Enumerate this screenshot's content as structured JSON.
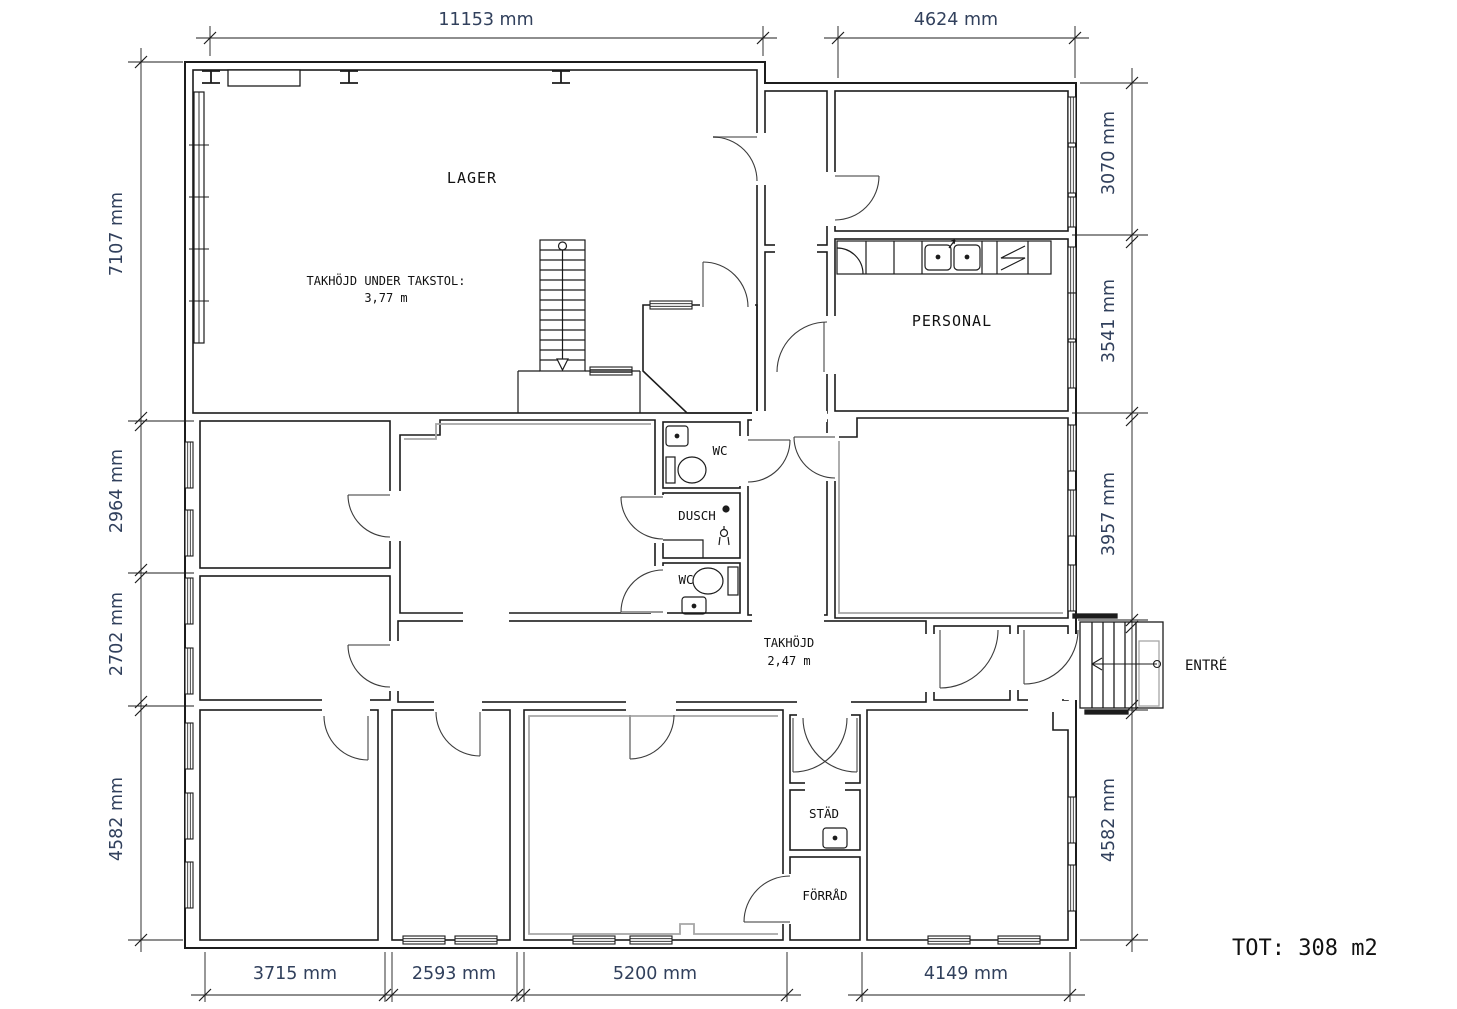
{
  "colors": {
    "wall": "#1c1c1c",
    "accent_gray": "#a6a6a6",
    "door_leaf_gray": "#9a9a9a",
    "dimension_text": "#31405c",
    "background": "#ffffff"
  },
  "dims": {
    "top": [
      "11153 mm",
      "4624 mm"
    ],
    "left": [
      "7107 mm",
      "2964 mm",
      "2702 mm",
      "4582 mm"
    ],
    "right": [
      "3070 mm",
      "3541 mm",
      "3957 mm",
      "4582 mm"
    ],
    "bottom": [
      "3715 mm",
      "2593 mm",
      "5200 mm",
      "4149 mm"
    ]
  },
  "rooms": {
    "lager": "LAGER",
    "personal": "PERSONAL",
    "wc_top": "WC",
    "dusch": "DUSCH",
    "wc_bottom": "WC",
    "stad": "STÄD",
    "forrad": "FÖRRÅD",
    "entre": "ENTRÉ"
  },
  "notes": {
    "lager_ceiling_label": "TAKHÖJD UNDER TAKSTOL:",
    "lager_ceiling_value": "3,77 m",
    "hall_ceiling_label": "TAKHÖJD",
    "hall_ceiling_value": "2,47 m",
    "total_area": "TOT: 308 m2"
  }
}
